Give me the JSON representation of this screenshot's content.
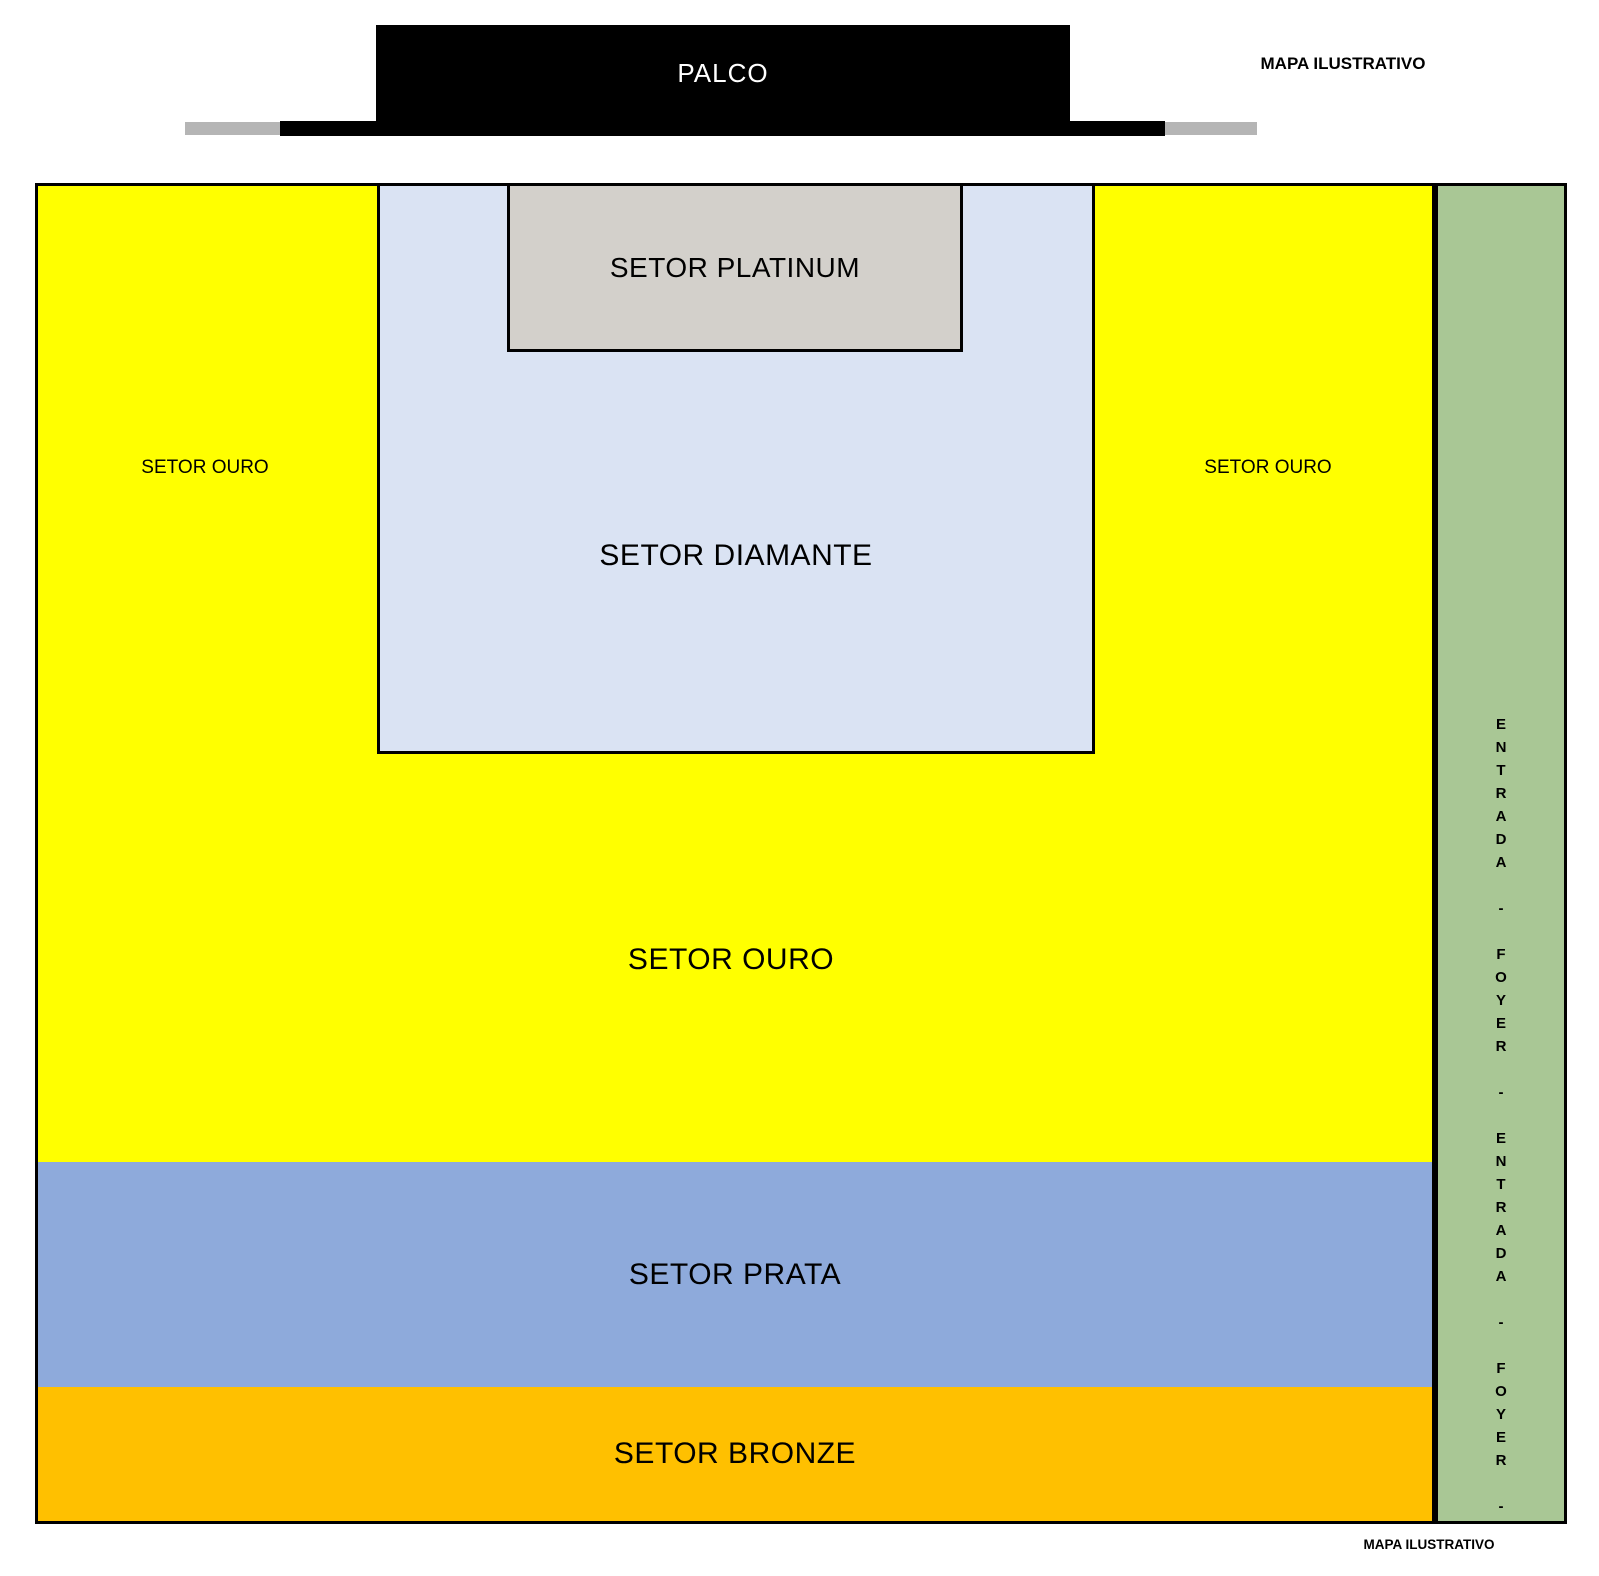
{
  "title_notes": {
    "top": "MAPA ILUSTRATIVO",
    "bottom": "MAPA ILUSTRATIVO"
  },
  "stage": {
    "label": "PALCO",
    "color": "#000000",
    "wing_color": "#B5B5B5"
  },
  "sectors": {
    "platinum": {
      "label": "SETOR PLATINUM",
      "color": "#D3D0CB"
    },
    "diamante": {
      "label": "SETOR DIAMANTE",
      "color": "#DAE3F3"
    },
    "ouro": {
      "label": "SETOR OURO",
      "side_label_left": "SETOR OURO",
      "side_label_right": "SETOR OURO",
      "color": "#FFFF00"
    },
    "prata": {
      "label": "SETOR PRATA",
      "color": "#8EAADB"
    },
    "bronze": {
      "label": "SETOR BRONZE",
      "color": "#FFC000"
    }
  },
  "entrance_strip": {
    "text": "ENTRADA - FOYER - ENTRADA - FOYER -",
    "color": "#A9C795"
  }
}
